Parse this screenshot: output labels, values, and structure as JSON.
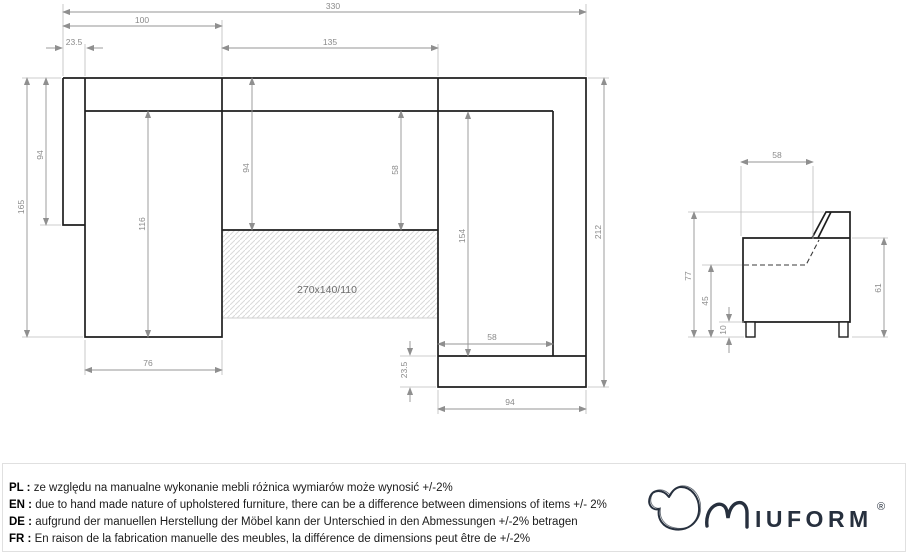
{
  "plan_view": {
    "bed_size_label": "270x140/110",
    "dims": {
      "overall_width": "330",
      "left_section_width": "100",
      "left_arm_width": "23.5",
      "middle_seat_width": "135",
      "left_total_depth": "165",
      "left_arm_depth": "94",
      "chaise_length": "116",
      "middle_total_depth": "94",
      "middle_seat_depth": "58",
      "right_seat_length": "154",
      "right_seat_width": "58",
      "right_bottom_band": "23.5",
      "right_section_width": "94",
      "overall_depth": "212",
      "chaise_seat_width": "76"
    }
  },
  "side_view": {
    "dims": {
      "seat_depth": "58",
      "total_height": "77",
      "seat_height": "45",
      "leg_height": "10",
      "arm_height": "61"
    }
  },
  "footer": {
    "notes": [
      {
        "code": "PL :",
        "text": "ze względu na manualne wykonanie mebli różnica wymiarów może wynosić +/-2%"
      },
      {
        "code": "EN :",
        "text": "due to hand made nature of upholstered furniture, there can be a difference between dimensions of items +/- 2%"
      },
      {
        "code": "DE :",
        "text": "aufgrund der manuellen Herstellung der Möbel kann der Unterschied in den Abmessungen +/-2% betragen"
      },
      {
        "code": "FR :",
        "text": "En raison de la fabrication manuelle des meubles, la différence de dimensions peut être de +/-2%"
      }
    ],
    "logo": {
      "brand_rest": "IUFORM",
      "registered": "®"
    }
  }
}
